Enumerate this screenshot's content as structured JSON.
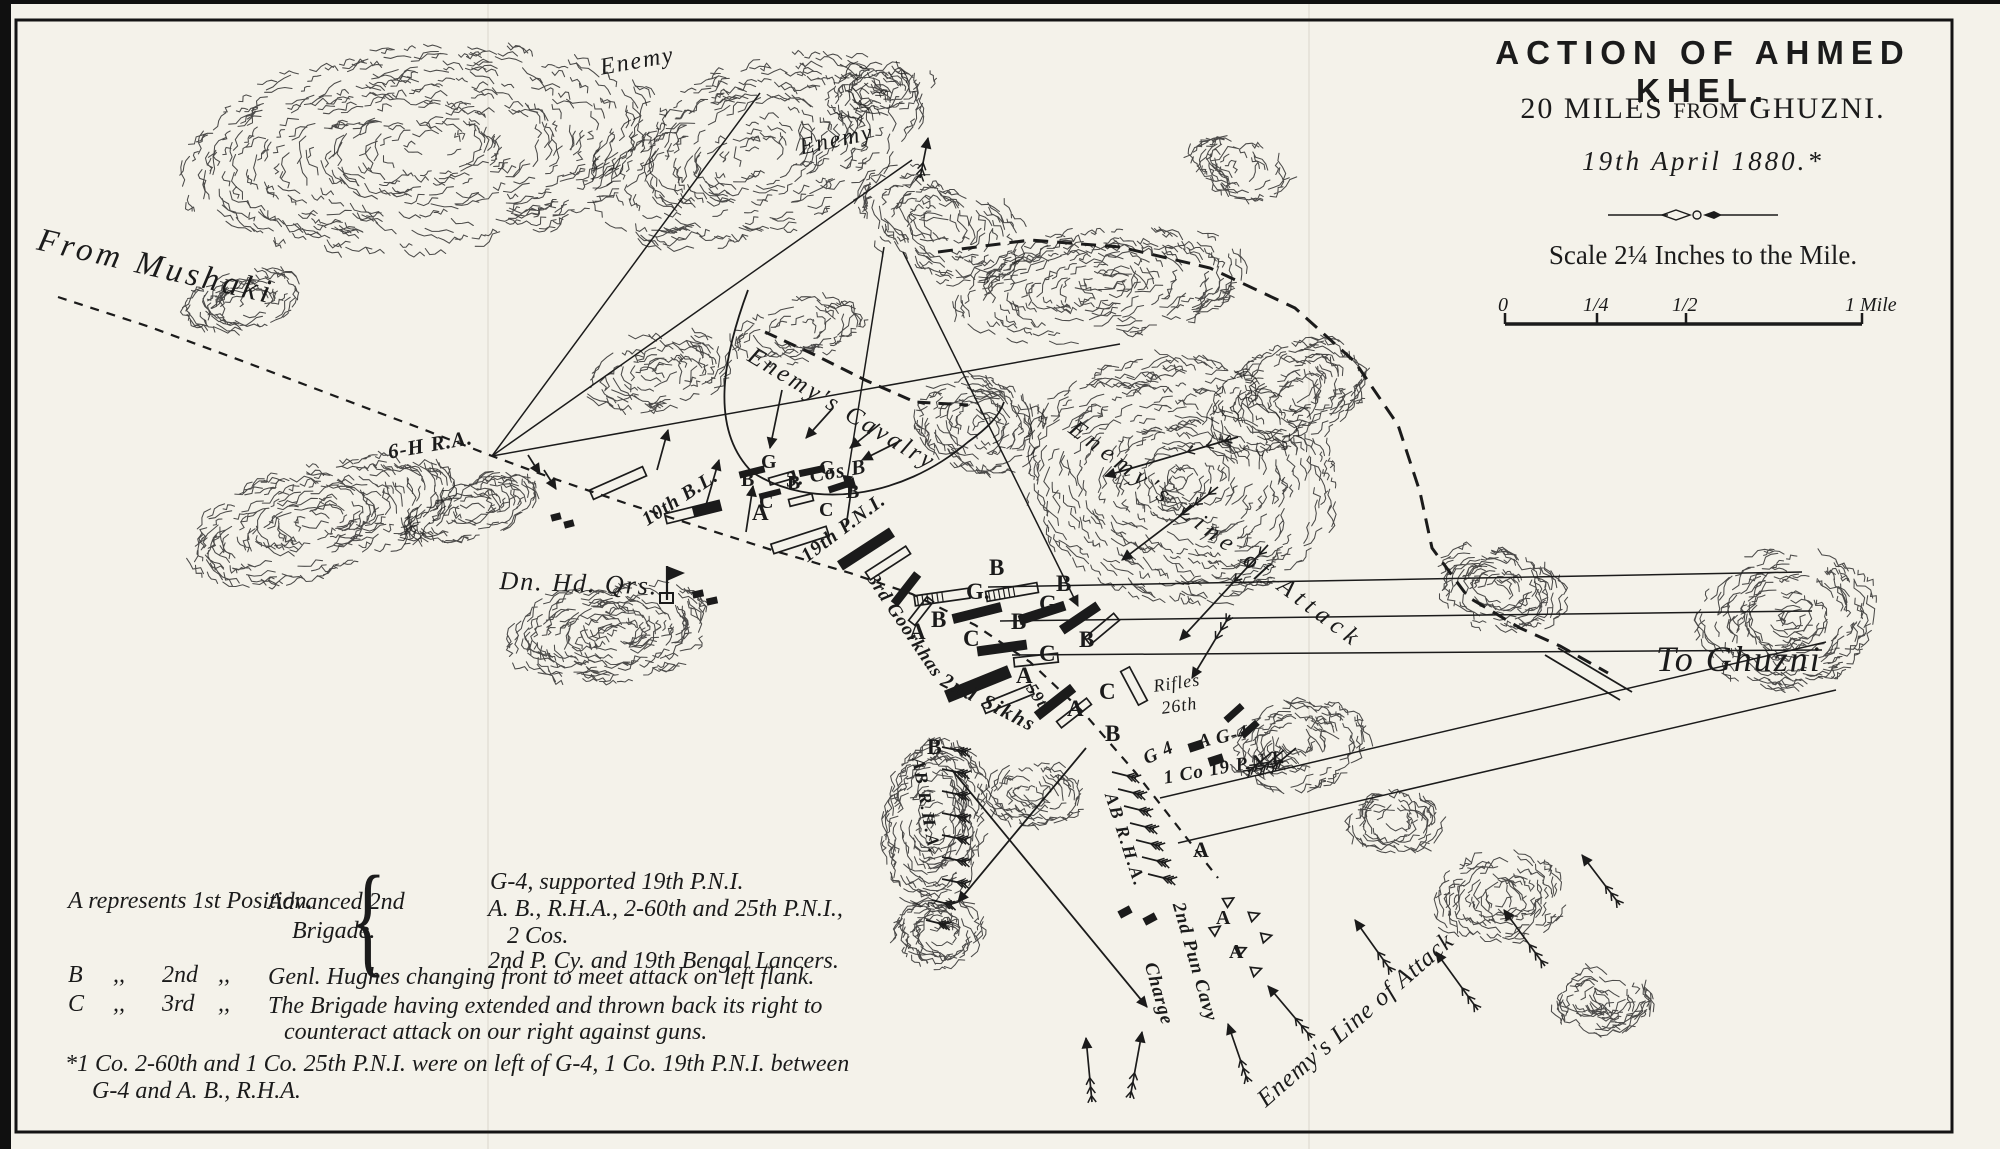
{
  "colors": {
    "ink": "#1b1b1b",
    "paper": "#f4f2ea"
  },
  "title_block": {
    "title": "ACTION OF AHMED KHEL.",
    "subtitle_p1": "20 MILES ",
    "subtitle_p2": "FROM",
    "subtitle_p3": " GHUZNI.",
    "date": "19th April 1880.*",
    "scale_text": "Scale 2¼ Inches to the Mile.",
    "scale_ticks": [
      "0",
      "1/4",
      "1/2",
      "1 Mile"
    ]
  },
  "legend": {
    "row_a": {
      "text": "A represents 1st Position.",
      "group_label_1": "Advanced 2nd",
      "group_label_2": "Brigade.",
      "brace": "{",
      "brace_items": [
        "G-4, supported 19th P.N.I.",
        "A. B., R.H.A., 2-60th and 25th P.N.I.,",
        "2 Cos.",
        "2nd P. Cy. and 19th Bengal Lancers."
      ]
    },
    "row_b": {
      "key": "B",
      "ditto1": ",,",
      "ord": "2nd",
      "ditto2": ",,",
      "text": "Genl. Hughes changing front to meet attack on left flank."
    },
    "row_c": {
      "key": "C",
      "ditto1": ",,",
      "ord": "3rd",
      "ditto2": ",,",
      "text_line1": "The Brigade having extended and thrown back its right to",
      "text_line2": "counteract attack on our right against guns."
    },
    "footnote_line1": "*1 Co. 2-60th and 1 Co. 25th P.N.I. were on left of G-4, 1 Co. 19th P.N.I. between",
    "footnote_line2": "G-4 and A. B., R.H.A."
  },
  "map_labels": [
    {
      "t": "From Mushaki",
      "x": 42,
      "y": 222,
      "r": 13,
      "s": 33,
      "ls": 4,
      "cls": "place"
    },
    {
      "t": "Enemy",
      "x": 598,
      "y": 55,
      "r": -10,
      "s": 24,
      "ls": 2,
      "cls": "place"
    },
    {
      "t": "Enemy",
      "x": 797,
      "y": 135,
      "r": -12,
      "s": 24,
      "ls": 2,
      "cls": "place"
    },
    {
      "t": "Enemy's Cavalry",
      "x": 757,
      "y": 342,
      "r": 31,
      "s": 25,
      "ls": 3,
      "cls": "place"
    },
    {
      "t": "Enemy's Line of Attack",
      "x": 1080,
      "y": 415,
      "r": 37,
      "s": 25,
      "ls": 6,
      "cls": "place"
    },
    {
      "t": "Enemy's Line of Attack",
      "x": 1252,
      "y": 1092,
      "r": -41,
      "s": 25,
      "ls": 1,
      "cls": "place"
    },
    {
      "t": "To Ghuzni",
      "x": 1656,
      "y": 638,
      "r": 0,
      "s": 36,
      "ls": 2,
      "cls": "place"
    },
    {
      "t": "Dn. Hd. Qrs.",
      "x": 500,
      "y": 566,
      "r": 2,
      "s": 26,
      "ls": 2,
      "cls": "place"
    },
    {
      "t": "6-H R.A.",
      "x": 386,
      "y": 440,
      "r": -10,
      "s": 21,
      "ls": 1,
      "cls": "unit"
    },
    {
      "t": "10th B.L.",
      "x": 638,
      "y": 512,
      "r": -33,
      "s": 20,
      "ls": 1,
      "cls": "unit"
    },
    {
      "t": "3. Cos B",
      "x": 784,
      "y": 468,
      "r": -10,
      "s": 21,
      "ls": 1,
      "cls": "unit"
    },
    {
      "t": "19th P.N.I.",
      "x": 797,
      "y": 549,
      "r": -37,
      "s": 20,
      "ls": 1,
      "cls": "unit"
    },
    {
      "t": "3rd Goorkhas",
      "x": 880,
      "y": 570,
      "r": 56,
      "s": 19,
      "ls": 1,
      "cls": "unit"
    },
    {
      "t": "2nd Sikhs",
      "x": 948,
      "y": 668,
      "r": 27,
      "s": 21,
      "ls": 2,
      "cls": "unit"
    },
    {
      "t": "59th",
      "x": 1038,
      "y": 680,
      "r": 56,
      "s": 17,
      "ls": 1,
      "cls": "unit"
    },
    {
      "t": "Rifles",
      "x": 1152,
      "y": 676,
      "r": -8,
      "s": 18,
      "ls": 1,
      "cls": "place"
    },
    {
      "t": "26th",
      "x": 1160,
      "y": 698,
      "r": -8,
      "s": 18,
      "ls": 1,
      "cls": "place"
    },
    {
      "t": "G 4",
      "x": 1140,
      "y": 750,
      "r": -25,
      "s": 19,
      "ls": 1,
      "cls": "unit"
    },
    {
      "t": "1 Co 19 P.N.I.",
      "x": 1162,
      "y": 768,
      "r": -10,
      "s": 19,
      "ls": 1,
      "cls": "unit"
    },
    {
      "t": "A G-4",
      "x": 1196,
      "y": 732,
      "r": -12,
      "s": 19,
      "ls": 1,
      "cls": "unit"
    },
    {
      "t": "AB R.H.A.",
      "x": 928,
      "y": 756,
      "r": 80,
      "s": 18,
      "ls": 2,
      "cls": "unit"
    },
    {
      "t": "AB R.H.A.",
      "x": 1120,
      "y": 790,
      "r": 72,
      "s": 18,
      "ls": 2,
      "cls": "unit"
    },
    {
      "t": "2nd Pun Cavy",
      "x": 1188,
      "y": 900,
      "r": 74,
      "s": 19,
      "ls": 1,
      "cls": "unit"
    },
    {
      "t": "Charge",
      "x": 1160,
      "y": 960,
      "r": 74,
      "s": 19,
      "ls": 1,
      "cls": "unit"
    },
    {
      "t": "A",
      "x": 752,
      "y": 500,
      "r": 0,
      "s": 23,
      "ls": 0,
      "cls": "letter"
    },
    {
      "t": "G",
      "x": 761,
      "y": 451,
      "r": 0,
      "s": 20,
      "ls": 0,
      "cls": "letter"
    },
    {
      "t": "B",
      "x": 741,
      "y": 469,
      "r": 0,
      "s": 20,
      "ls": 0,
      "cls": "letter"
    },
    {
      "t": "C",
      "x": 759,
      "y": 491,
      "r": 0,
      "s": 20,
      "ls": 0,
      "cls": "letter"
    },
    {
      "t": "B",
      "x": 787,
      "y": 472,
      "r": 0,
      "s": 20,
      "ls": 0,
      "cls": "letter"
    },
    {
      "t": "G",
      "x": 819,
      "y": 457,
      "r": 0,
      "s": 20,
      "ls": 0,
      "cls": "letter"
    },
    {
      "t": "B",
      "x": 846,
      "y": 481,
      "r": 0,
      "s": 20,
      "ls": 0,
      "cls": "letter"
    },
    {
      "t": "C",
      "x": 819,
      "y": 499,
      "r": 0,
      "s": 20,
      "ls": 0,
      "cls": "letter"
    },
    {
      "t": "B",
      "x": 989,
      "y": 555,
      "r": 0,
      "s": 23,
      "ls": 0,
      "cls": "letter"
    },
    {
      "t": "G.",
      "x": 966,
      "y": 579,
      "r": 0,
      "s": 23,
      "ls": 0,
      "cls": "letter"
    },
    {
      "t": "B",
      "x": 1056,
      "y": 571,
      "r": 0,
      "s": 23,
      "ls": 0,
      "cls": "letter"
    },
    {
      "t": "G",
      "x": 1039,
      "y": 591,
      "r": 0,
      "s": 23,
      "ls": 0,
      "cls": "letter"
    },
    {
      "t": "B",
      "x": 931,
      "y": 607,
      "r": 0,
      "s": 23,
      "ls": 0,
      "cls": "letter"
    },
    {
      "t": "A",
      "x": 909,
      "y": 619,
      "r": 0,
      "s": 23,
      "ls": 0,
      "cls": "letter"
    },
    {
      "t": "C",
      "x": 963,
      "y": 626,
      "r": 0,
      "s": 23,
      "ls": 0,
      "cls": "letter"
    },
    {
      "t": "B",
      "x": 1011,
      "y": 609,
      "r": 0,
      "s": 23,
      "ls": 0,
      "cls": "letter"
    },
    {
      "t": "C",
      "x": 1039,
      "y": 641,
      "r": 0,
      "s": 23,
      "ls": 0,
      "cls": "letter"
    },
    {
      "t": "B",
      "x": 1079,
      "y": 627,
      "r": 0,
      "s": 23,
      "ls": 0,
      "cls": "letter"
    },
    {
      "t": "A",
      "x": 1016,
      "y": 663,
      "r": 0,
      "s": 23,
      "ls": 0,
      "cls": "letter"
    },
    {
      "t": "C",
      "x": 1099,
      "y": 679,
      "r": 0,
      "s": 23,
      "ls": 0,
      "cls": "letter"
    },
    {
      "t": "A",
      "x": 1067,
      "y": 696,
      "r": 0,
      "s": 23,
      "ls": 0,
      "cls": "letter"
    },
    {
      "t": "B",
      "x": 1105,
      "y": 721,
      "r": 0,
      "s": 23,
      "ls": 0,
      "cls": "letter"
    },
    {
      "t": "B",
      "x": 927,
      "y": 734,
      "r": 0,
      "s": 22,
      "ls": 0,
      "cls": "letter"
    },
    {
      "t": "A",
      "x": 1193,
      "y": 837,
      "r": 0,
      "s": 22,
      "ls": 0,
      "cls": "letter"
    },
    {
      "t": "A",
      "x": 1216,
      "y": 907,
      "r": 0,
      "s": 20,
      "ls": 0,
      "cls": "letter"
    },
    {
      "t": "A",
      "x": 1229,
      "y": 941,
      "r": 0,
      "s": 20,
      "ls": 0,
      "cls": "letter"
    }
  ]
}
